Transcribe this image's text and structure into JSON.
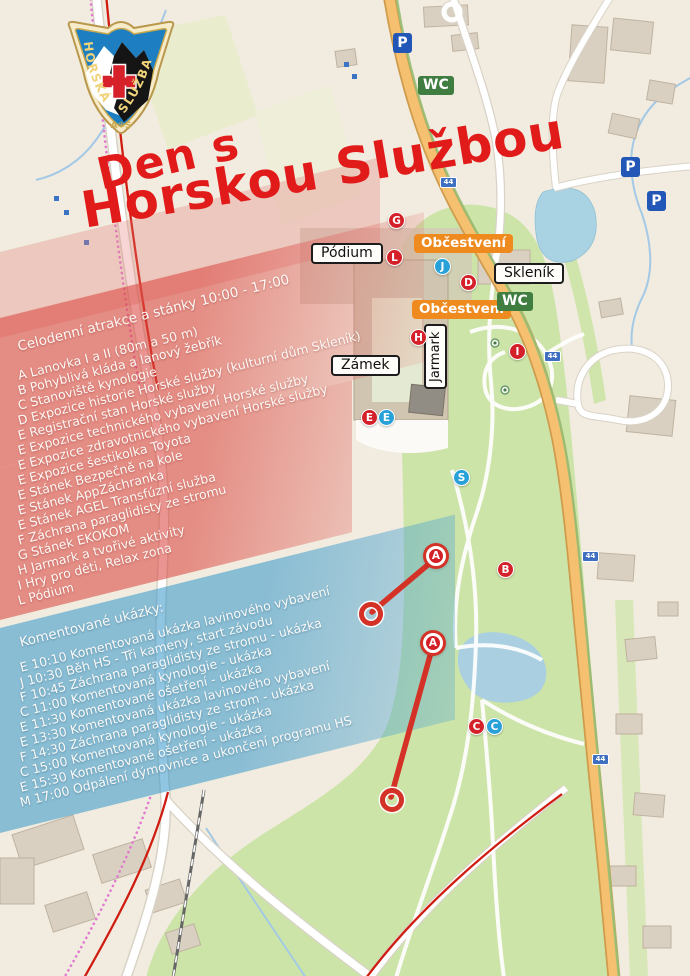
{
  "title": {
    "line1": "Den s",
    "line2": "Horskou Službou"
  },
  "logo": {
    "left": "HORSKÁ",
    "right": "SLUŽBA",
    "bottom": "A❄S"
  },
  "attractions": {
    "header": "Celodenní atrakce a stánky 10:00 - 17:00",
    "items": [
      "A Lanovka I a II (80m a 50 m)",
      "B Pohyblivá kláda a lanový žebřík",
      "C Stanoviště kynologie",
      "D Expozice historie Horské služby (kulturní dům Skleník)",
      "E Registrační stan Horské služby",
      "E Expozice technického vybavení Horské služby",
      "E Expozice zdravotnického vybavení Horské služby",
      "E Expozice šestikolka Toyota",
      "E Stánek Bezpečně na kole",
      "E Stánek AppZáchranka",
      "E Stánek AGEL Transfúzní služba",
      "F Záchrana paraglidisty ze stromu",
      "G Stánek EKOKOM",
      "H Jarmark a tvořivé aktivity",
      "I Hry pro děti, Relax zona",
      "L Pódium"
    ]
  },
  "schedule": {
    "header": "Komentované ukázky:",
    "items": [
      "E 10:10 Komentovaná ukázka lavinového vybavení",
      "J 10:30 Běh HS - Tři kameny, start závodu",
      "F 10:45 Záchrana paraglidisty ze stromu - ukázka",
      "C 11:00 Komentovaná kynologie - ukázka",
      "E 11:30 Komentované ošetření - ukázka",
      "E 13:30 Komentovaná ukázka lavinového vybavení",
      "F 14:30 Záchrana paraglidisty ze strom - ukázka",
      "C 15:00 Komentovaná kynologie - ukázka",
      "E 15:30 Komentované ošetření - ukázka",
      "M 17:00 Odpálení dýmovnice a ukončení programu HS"
    ]
  },
  "map": {
    "labels": {
      "podium": "Pódium",
      "refreshment": "Občestvení",
      "sklenik": "Skleník",
      "zamek": "Zámek",
      "jarmark": "Jarmark",
      "wc": "WC",
      "parking": "P",
      "route": "44"
    },
    "markers": [
      {
        "letter": "G",
        "color": "red"
      },
      {
        "letter": "L",
        "color": "red"
      },
      {
        "letter": "J",
        "color": "blue"
      },
      {
        "letter": "D",
        "color": "red"
      },
      {
        "letter": "H",
        "color": "red"
      },
      {
        "letter": "I",
        "color": "red"
      },
      {
        "letter": "E",
        "color": "red"
      },
      {
        "letter": "E",
        "color": "blue"
      },
      {
        "letter": "S",
        "color": "blue"
      },
      {
        "letter": "A",
        "color": "red",
        "variant": "ring"
      },
      {
        "letter": "B",
        "color": "red"
      },
      {
        "letter": "A",
        "color": "red",
        "variant": "ring"
      },
      {
        "letter": "C",
        "color": "red"
      },
      {
        "letter": "C",
        "color": "blue"
      }
    ],
    "colors": {
      "title_red": "#e11a1a",
      "marker_red": "#d42029",
      "marker_blue": "#28a0d8",
      "band_red": "#db4842",
      "band_blue": "#3496ca",
      "label_orange": "#ef8a1f",
      "wc_green": "#3f7d41",
      "parking_blue": "#2257b8",
      "route_blue": "#3f6fc0",
      "park_green": "#cde4a9",
      "water_blue": "#a9d2e3",
      "road_orange": "#f5c070"
    }
  }
}
